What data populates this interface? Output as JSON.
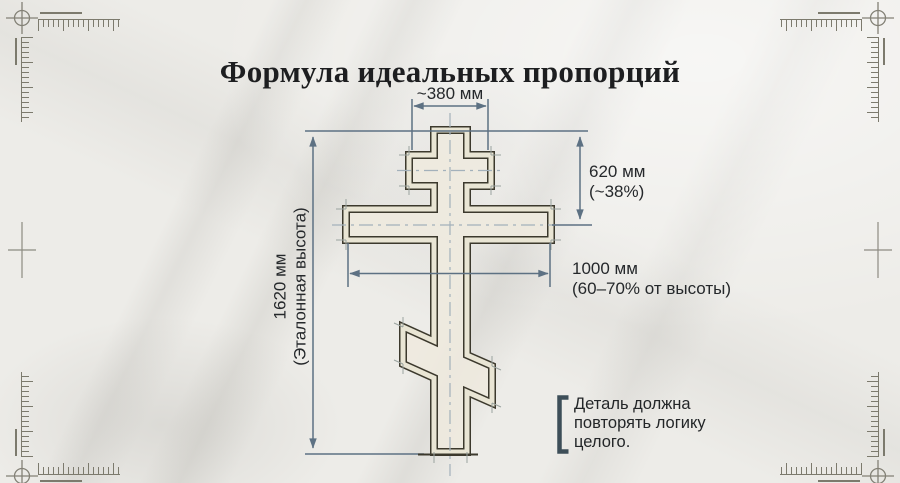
{
  "title": "Формула идеальных пропорций",
  "dimensions": {
    "top_width": {
      "value": "~380 мм"
    },
    "upper_height": {
      "value": "620 мм",
      "note": "(~38%)"
    },
    "crossbar_width": {
      "value": "1000 мм",
      "note": "(60–70% от высоты)"
    },
    "total_height": {
      "value": "1620 мм",
      "note": "(Эталонная высота)"
    }
  },
  "callout": {
    "text": "Деталь должна повторять логику целого."
  },
  "drawing": {
    "subject": "orthodox-eight-pointed-cross-technical-drawing"
  },
  "colors": {
    "dimension_line": "#5d7183",
    "outline": "#3c392d",
    "callout_bracket": "#3d4e58",
    "text": "#25282b",
    "background": "#edece8"
  }
}
